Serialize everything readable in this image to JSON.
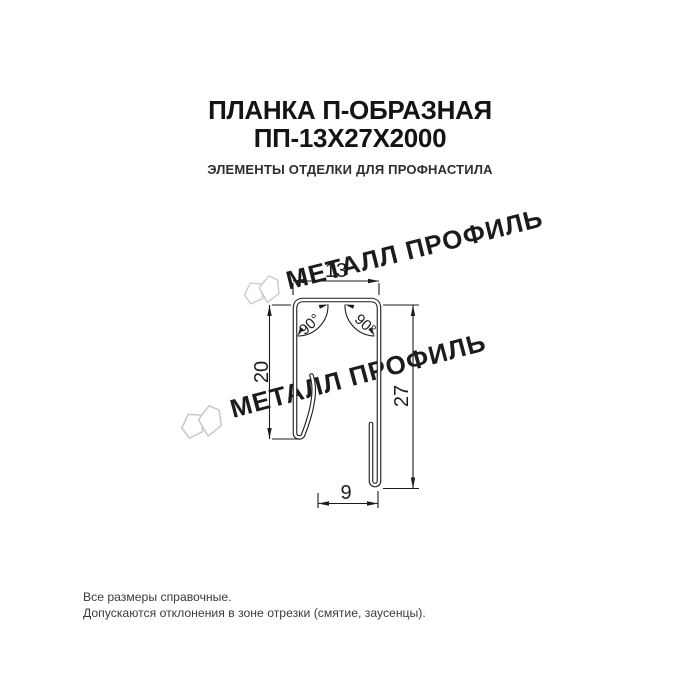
{
  "header": {
    "title_line1": "ПЛАНКА П-ОБРАЗНАЯ",
    "title_line2": "ПП-13Х27Х2000",
    "subtitle": "ЭЛЕМЕНТЫ ОТДЕЛКИ ДЛЯ ПРОФНАСТИЛА"
  },
  "drawing": {
    "dim_top_width": "13",
    "dim_left_height": "20",
    "dim_right_height": "27",
    "dim_bottom_width": "9",
    "angle_left": "90°",
    "angle_right": "90°",
    "watermark_text": "МЕТАЛЛ ПРОФИЛЬ",
    "colors": {
      "line": "#1c1c1c",
      "watermark": "#cacaca"
    }
  },
  "footer": {
    "note_line1": "Все размеры справочные.",
    "note_line2": "Допускаются отклонения в зоне отрезки (смятие, заусенцы)."
  }
}
